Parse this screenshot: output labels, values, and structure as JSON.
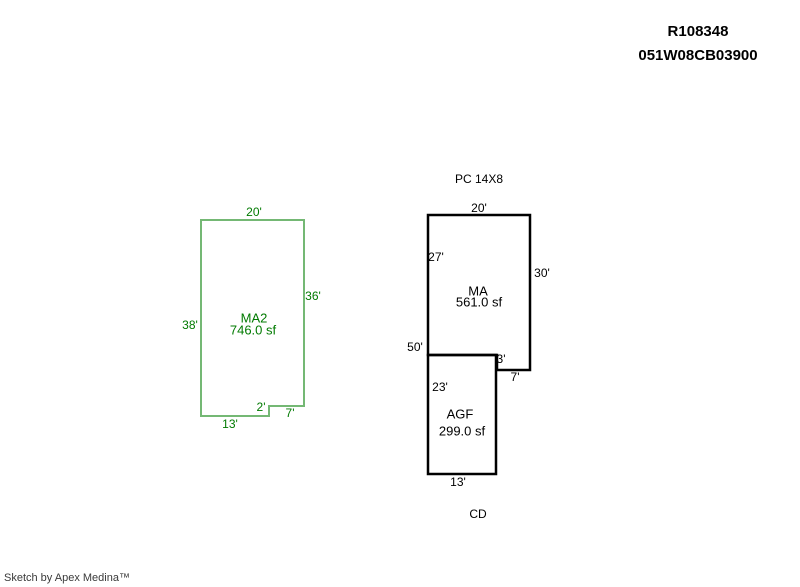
{
  "header": {
    "record_number": "R108348",
    "parcel_number": "051W08CB03900"
  },
  "sketch": {
    "ma2": {
      "name": "MA2",
      "area": "746.0 sf",
      "line_color": "#74b874",
      "text_color": "#007a00",
      "dims": {
        "top": "20'",
        "right": "36'",
        "left": "38'",
        "step": "2'",
        "bottom_right": "7'",
        "bottom": "13'"
      }
    },
    "ma": {
      "name": "MA",
      "area": "561.0 sf",
      "line_color": "#000000",
      "text_color": "#000000",
      "dims": {
        "top": "20'",
        "left": "27'",
        "right": "30'",
        "left_total": "50'",
        "step": "3'",
        "bottom_right": "7'"
      }
    },
    "agf": {
      "name": "AGF",
      "area": "299.0 sf",
      "line_color": "#000000",
      "text_color": "#000000",
      "dims": {
        "left": "23'",
        "bottom": "13'"
      }
    },
    "annotations": {
      "pc": "PC 14X8",
      "cd": "CD"
    }
  },
  "footer": {
    "credit": "Sketch by Apex Medina™"
  }
}
